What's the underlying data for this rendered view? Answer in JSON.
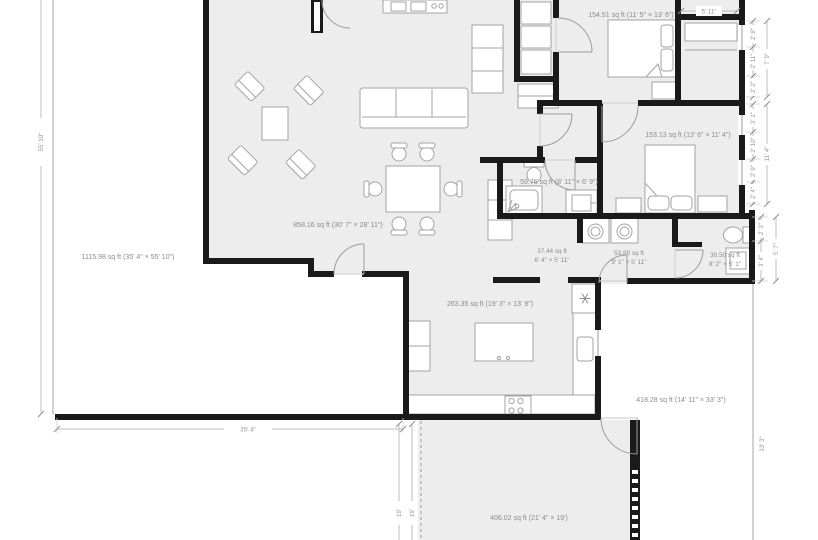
{
  "rooms": {
    "living": "858.16 sq ft (30' 7\" × 28' 11\")",
    "outdoor_left": "1115.98 sq ft (35' 4\" × 55' 10\")",
    "bedroom_top": "154.51 sq ft (11' 5\" × 13' 6\")",
    "bedroom_right": "153.13 sq ft (13' 6\" × 11' 4\")",
    "bathroom": "59.76 sq ft (8' 11\" × 6' 9\")",
    "hall": {
      "area": "37.44 sq ft",
      "size": "6' 4\" × 5' 11\""
    },
    "laundry": {
      "area": "53.89 sq ft",
      "size": "9' 1\" × 5' 11\""
    },
    "powder": {
      "area": "30.50 sq ft",
      "size": "8' 2\" × 5' 1\""
    },
    "kitchen": "263.35 sq ft (19' 3\" × 13' 9\")",
    "outdoor_right": "418.28 sq ft (14' 11\" × 33' 3\")",
    "garage": "406.02 sq ft (21' 4\" × 19')"
  },
  "dims": {
    "left": "55' 10\"",
    "bottom": "35' 4\"",
    "garage_a": "19'",
    "garage_b": "19'",
    "closet_top": "5' 11\"",
    "chain_top": [
      "2' 8\"",
      "2' 11\"",
      "2' 2\""
    ],
    "chain_top_total": "7' 9\"",
    "chain_mid": [
      "3' 1\"",
      "2' 10\"",
      "2' 9\"",
      "2' 4\""
    ],
    "chain_mid_total": "11' 4\"",
    "chain_low": [
      "2' 3\"",
      "3' 4\""
    ],
    "chain_low_total": "5' 7\"",
    "right": "33' 3\""
  },
  "colors": {
    "wall": "#1a1a1a",
    "room_fill": "#ededed",
    "label_text": "#8c8c8c",
    "dim_text": "#999999"
  }
}
